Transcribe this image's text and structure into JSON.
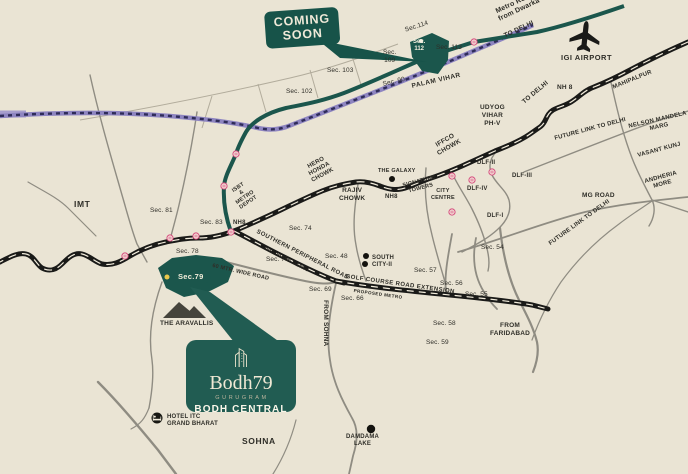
{
  "title": "Bodh79 Bodh Central location map",
  "colors": {
    "background": "#EAE4D4",
    "teal_accent": "#1B564C",
    "road_black": "#1A1A18",
    "road_gray": "#8F8C82",
    "metro_purple": "#8E85C1",
    "metro_purple_dash": "#2F2C59",
    "station_pink": "#D6497C",
    "cream_text": "#EFE9D8",
    "label_text": "#2F2E28"
  },
  "icons": {
    "airport": "plane-icon",
    "hotel": "hotel-bed-icon",
    "aravallis": "mountains-icon",
    "metro_station": "metro-station-icon",
    "landmark": "dot-marker",
    "site_marker": "location-dot",
    "logo_building": "building-icon"
  },
  "badges": {
    "coming_soon": "COMING\nSOON",
    "sec112": "Sec.\n112",
    "sec79": "Sec.79"
  },
  "logo": {
    "brand": "Bodh79",
    "city": "GURUGRAM",
    "project": "BODH CENTRAL"
  },
  "labels": {
    "metro_route": "Metro Route\nfrom Dwarka",
    "to_delhi_metro": "TO DELHI",
    "to_delhi_nh8": "TO DELHI",
    "igi_airport": "IGI AIRPORT",
    "nh8": "NH 8",
    "mahipalpur": "MAHIPALPUR",
    "sec114": "Sec.114",
    "sec113": "Sec. 113",
    "sec109": "Sec.\n109",
    "sec103": "Sec. 103",
    "sec102": "Sec. 102",
    "sec90": "Sec. 90",
    "palam_vihar": "PALAM VIHAR",
    "udyog_vihar": "UDYOG\nVIHAR\nPH-V",
    "iffco_chowk": "IFFCO\nCHOWK",
    "dlf2": "DLF-II",
    "dlf3": "DLF-III",
    "dlf4": "DLF-IV",
    "dlf1": "DLF-I",
    "signature_towers": "SIGNATURE\nTOWERS",
    "city_centre": "CITY\nCENTRE",
    "the_galaxy": "THE GALAXY",
    "nh8_a": "NH8",
    "nh8_b": "NH8",
    "hero_honda_chowk": "HERO\nHONDA\nCHOWK",
    "rajiv_chowk": "RAJIV\nCHOWK",
    "isbt_metro_depot": "ISBT\n&\nMETRO\nDEPOT",
    "imt": "IMT",
    "sec81": "Sec. 81",
    "sec83": "Sec. 83",
    "sec78": "Sec. 78",
    "sec75": "Sec. 75",
    "sec74": "Sec. 74",
    "southern_peripheral_road": "SOUTHERN PERIPHERAL ROAD",
    "proposed_metro_spr": "PROPOSED METRO",
    "wide_road": "60 MTR. WIDE ROAD",
    "sec48": "Sec. 48",
    "south_city": "SOUTH\nCITY-II",
    "sec57": "Sec. 57",
    "sec56": "Sec. 56",
    "sec55": "Sec. 55",
    "sec54": "Sec. 54",
    "golf_course_road_ext": "GOLF COURSE ROAD EXTENSION",
    "proposed_metro_gcre": "PROPOSED METRO",
    "sec69": "Sec. 69",
    "sec66": "Sec. 66",
    "sec58": "Sec. 58",
    "sec59": "Sec. 59",
    "from_faridabad": "FROM\nFARIDABAD",
    "from_sohna": "FROM SOHNA",
    "future_link_a": "FUTURE LINK TO DELHI",
    "future_link_b": "FUTURE LINK TO DELHI",
    "nelson_mandela_marg": "NELSON MANDELA\nMARG",
    "vasant_kunj": "VASANT KUNJ",
    "andheria_more": "ANDHERIA\nMORE",
    "mg_road": "MG ROAD",
    "aravallis": "THE ARAVALLIS",
    "hotel_itc": "HOTEL ITC\nGRAND BHARAT",
    "sohna": "SOHNA",
    "damdama_lake": "DAMDAMA\nLAKE"
  }
}
